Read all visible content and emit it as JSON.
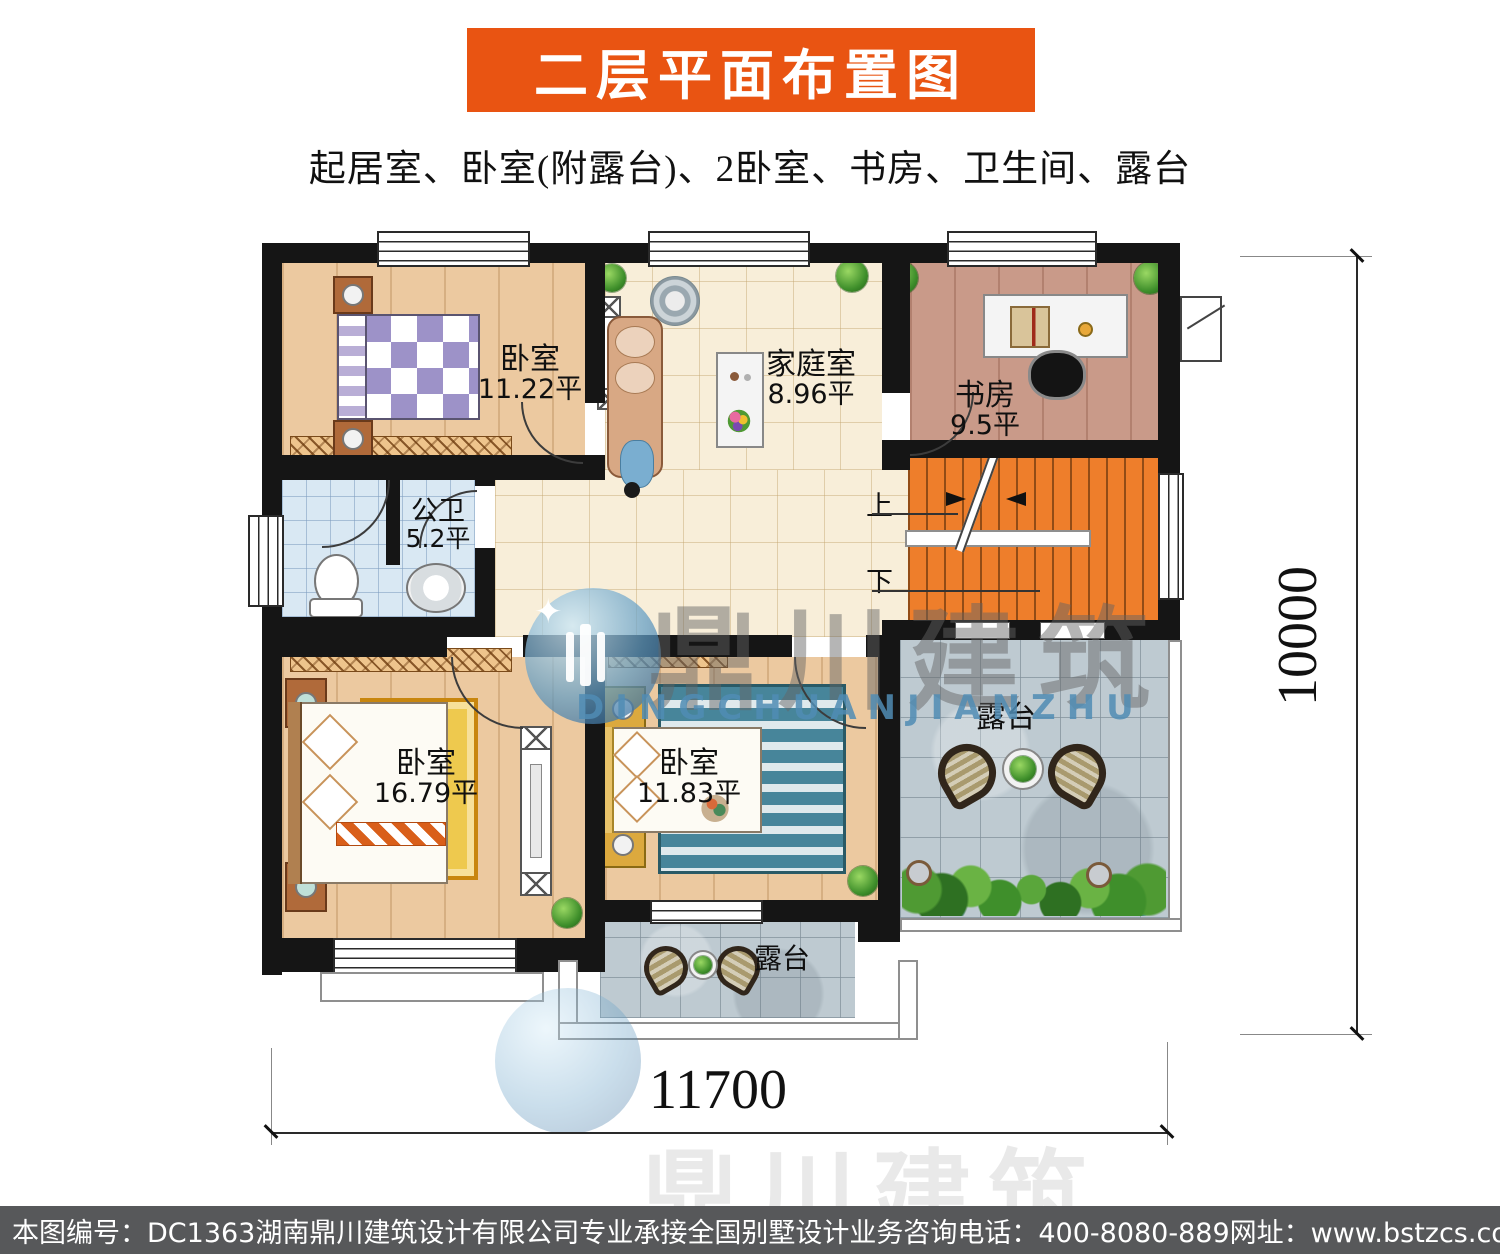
{
  "header": {
    "title": "二层平面布置图",
    "subtitle": "起居室、卧室(附露台)、2卧室、书房、卫生间、露台",
    "banner_color": "#E95412"
  },
  "rooms": {
    "bedroom_top_left": {
      "name": "卧室",
      "area": "11.22平"
    },
    "family_room": {
      "name": "家庭室",
      "area": "8.96平"
    },
    "study": {
      "name": "书房",
      "area": "9.5平"
    },
    "bathroom": {
      "name": "公卫",
      "area": "5.2平"
    },
    "bedroom_bottom_left": {
      "name": "卧室",
      "area": "16.79平"
    },
    "bedroom_bottom_center": {
      "name": "卧室",
      "area": "11.83平"
    },
    "terrace_main": {
      "name": "露台"
    },
    "terrace_small": {
      "name": "露台"
    }
  },
  "stairs": {
    "up_label": "上",
    "down_label": "下"
  },
  "dimensions": {
    "bottom_width": "11700",
    "right_height": "10000"
  },
  "watermark": {
    "cn": "鼎川建筑",
    "en": "DINGCHUANJIANZHU"
  },
  "footer": {
    "drawing_no": "本图编号：DC1363",
    "company": "湖南鼎川建筑设计有限公司专业承接全国别墅设计业务",
    "phone": "咨询电话：400-8080-889",
    "website": "网址：www.bstzcs.com"
  },
  "colors": {
    "banner": "#E95412",
    "stairs": "#EE7E2B",
    "wall": "#151515"
  }
}
